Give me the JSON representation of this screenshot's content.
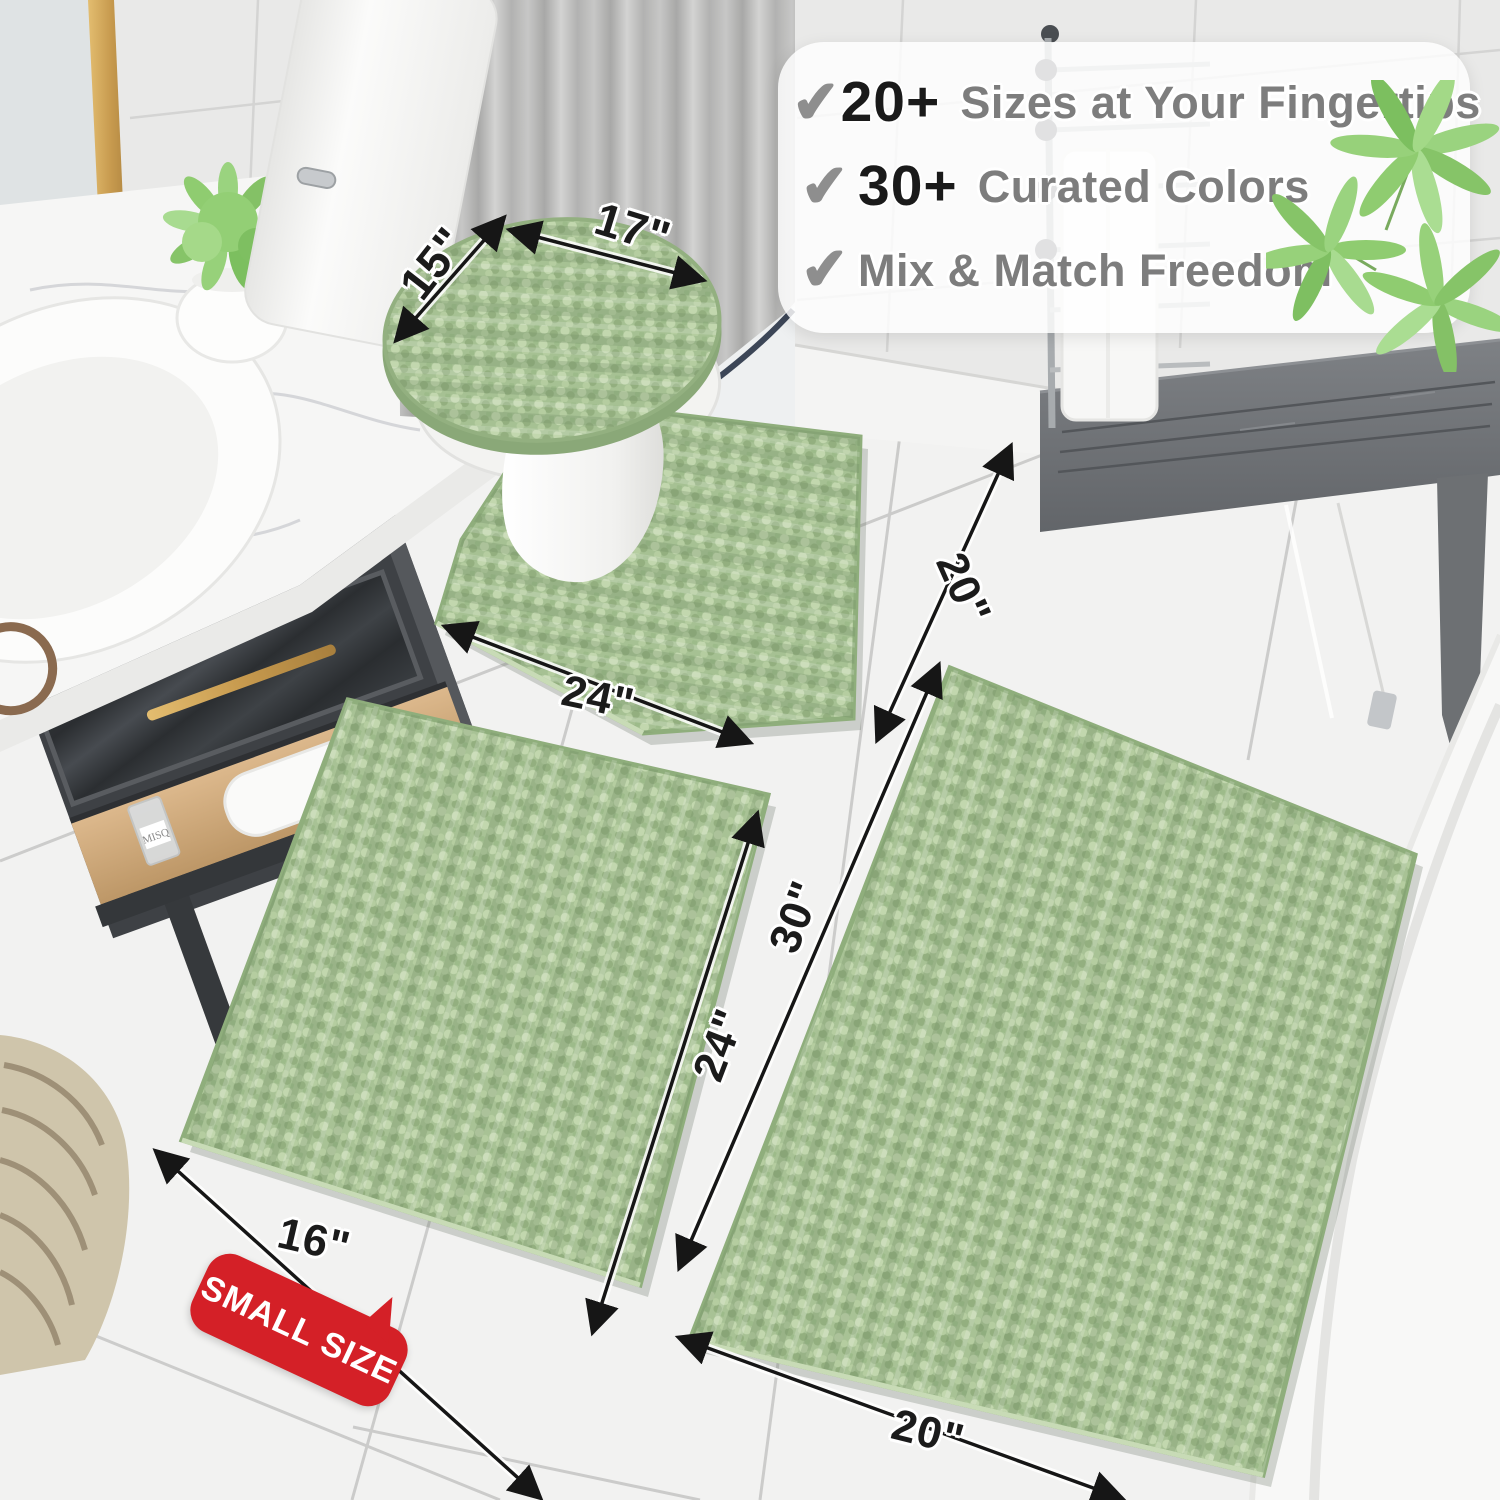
{
  "features": {
    "rows": [
      {
        "check": "✔",
        "number": "20+",
        "label": "Sizes at Your Fingertips"
      },
      {
        "check": "✔",
        "number": "30+",
        "label": "Curated Colors"
      },
      {
        "check": "✔",
        "number": "",
        "label": "Mix & Match Freedom"
      }
    ]
  },
  "annotations": {
    "lid_depth": "15\"",
    "lid_width": "17\"",
    "contour_width": "24\"",
    "contour_depth": "20\"",
    "small_rug_length": "24\"",
    "large_rug_length": "30\"",
    "small_rug_width": "16\"",
    "large_rug_width": "20\""
  },
  "badge": {
    "label": "SMALL SIZE"
  },
  "vanity": {
    "bottle_label": "MISQ"
  },
  "colors": {
    "rug_green": "#aac497",
    "rug_green_light": "#c2d7ae",
    "rug_green_dark": "#93af7f",
    "badge_red": "#d42027",
    "dimension_text": "#1b1b1b",
    "feature_text_gray": "#7d7d7d",
    "feature_number_black": "#1a1a1a",
    "check_gray": "#8e8e8e",
    "gold_accent": "#c19a55"
  }
}
